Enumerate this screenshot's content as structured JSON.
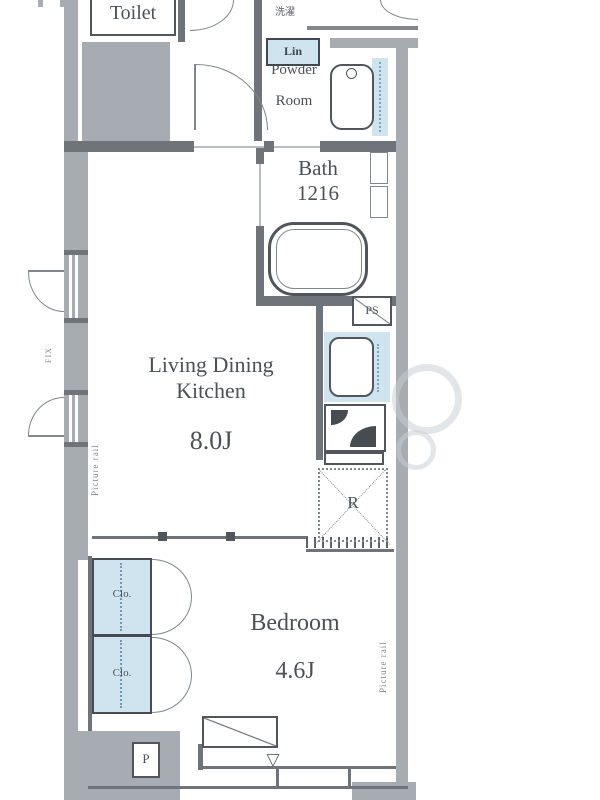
{
  "rooms": {
    "toilet": "Toilet",
    "laundry": "洗濯",
    "linen": "Lin",
    "powder_line1": "Powder",
    "powder_line2": "Room",
    "bath": "Bath",
    "bath_size": "1216",
    "ldk_line1": "Living Dining",
    "ldk_line2": "Kitchen",
    "ldk_size": "8.0J",
    "bedroom": "Bedroom",
    "bedroom_size": "4.6J",
    "closet1": "Clo.",
    "closet2": "Clo."
  },
  "labels": {
    "ps": "PS",
    "fridge": "R",
    "pipe": "P",
    "picture_rail_left": "Picture rail",
    "picture_rail_right": "Picture rail",
    "window_note": "FIX",
    "entry_marker": "▽"
  },
  "colors": {
    "wall_fill": "#a7acb2",
    "line": "#51565c",
    "accent_blue": "#cfe4ee",
    "text": "#4c5157"
  }
}
